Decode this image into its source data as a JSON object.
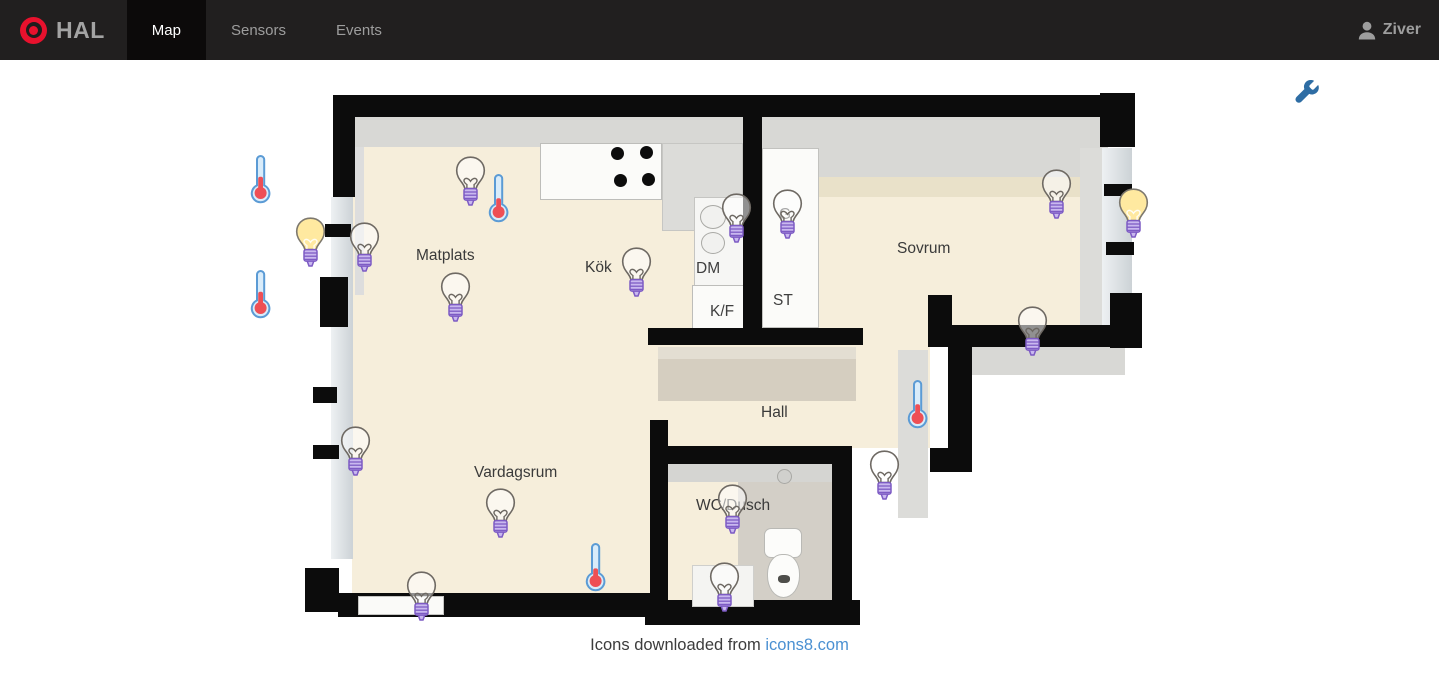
{
  "navbar": {
    "brand": "HAL",
    "tabs": [
      {
        "label": "Map",
        "active": true
      },
      {
        "label": "Sensors",
        "active": false
      },
      {
        "label": "Events",
        "active": false
      }
    ],
    "user": "Ziver"
  },
  "footer": {
    "text": "Icons downloaded from ",
    "link_label": "icons8.com"
  },
  "colors": {
    "accent_red": "#e8112d",
    "wrench_blue": "#2e6da4",
    "link_blue": "#4a90d2",
    "bulb_on_yellow": "#ffe9a0",
    "bulb_base_purple": "#c9b8ef",
    "thermometer_red": "#ee4f55",
    "wall_black": "#0c0c0c",
    "floor_beige": "#f6eedb"
  },
  "floorplan": {
    "labels": [
      {
        "label": "Matplats",
        "x": 416,
        "y": 247,
        "kind": "room"
      },
      {
        "label": "Kök",
        "x": 585,
        "y": 259,
        "kind": "room"
      },
      {
        "label": "Sovrum",
        "x": 897,
        "y": 240,
        "kind": "room"
      },
      {
        "label": "Hall",
        "x": 761,
        "y": 404,
        "kind": "room"
      },
      {
        "label": "Vardagsrum",
        "x": 474,
        "y": 464,
        "kind": "room"
      },
      {
        "label": "WC/Dusch",
        "x": 696,
        "y": 497,
        "kind": "room"
      },
      {
        "label": "DM",
        "x": 696,
        "y": 260,
        "kind": "appliance"
      },
      {
        "label": "K/F",
        "x": 710,
        "y": 303,
        "kind": "appliance"
      },
      {
        "label": "ST",
        "x": 773,
        "y": 292,
        "kind": "appliance"
      },
      {
        "label": "G",
        "x": 779,
        "y": 206,
        "kind": "appliance"
      }
    ],
    "sensors": [
      {
        "id": "temp-left-upper",
        "type": "thermometer",
        "level": 0.55,
        "x": 249,
        "y": 152
      },
      {
        "id": "temp-left-lower",
        "type": "thermometer",
        "level": 0.55,
        "x": 249,
        "y": 267
      },
      {
        "id": "temp-matplats",
        "type": "thermometer",
        "level": 0.45,
        "x": 487,
        "y": 171
      },
      {
        "id": "temp-hall",
        "type": "thermometer",
        "level": 0.45,
        "x": 906,
        "y": 377
      },
      {
        "id": "temp-vardagsrum",
        "type": "thermometer",
        "level": 0.4,
        "x": 584,
        "y": 540
      },
      {
        "id": "lamp-entry",
        "type": "bulb",
        "state": "on",
        "x": 294,
        "y": 216
      },
      {
        "id": "lamp-sovrum-window",
        "type": "bulb",
        "state": "on",
        "x": 1117,
        "y": 187
      },
      {
        "id": "lamp-matplats-wall",
        "type": "bulb",
        "state": "off",
        "x": 348,
        "y": 221
      },
      {
        "id": "lamp-matplats-top",
        "type": "bulb",
        "state": "off",
        "x": 454,
        "y": 155
      },
      {
        "id": "lamp-matplats",
        "type": "bulb",
        "state": "off",
        "x": 439,
        "y": 271
      },
      {
        "id": "lamp-kok",
        "type": "bulb",
        "state": "off",
        "x": 620,
        "y": 246
      },
      {
        "id": "lamp-sink",
        "type": "bulb",
        "state": "off",
        "x": 720,
        "y": 192
      },
      {
        "id": "lamp-garderob",
        "type": "bulb",
        "state": "off",
        "x": 771,
        "y": 188
      },
      {
        "id": "lamp-sovrum-top",
        "type": "bulb",
        "state": "off",
        "x": 1040,
        "y": 168
      },
      {
        "id": "lamp-sovrum-bottom",
        "type": "bulb",
        "state": "off",
        "x": 1016,
        "y": 305
      },
      {
        "id": "lamp-hall",
        "type": "bulb",
        "state": "off",
        "x": 868,
        "y": 449
      },
      {
        "id": "lamp-vardagsrum-wall",
        "type": "bulb",
        "state": "off",
        "x": 339,
        "y": 425
      },
      {
        "id": "lamp-vardagsrum",
        "type": "bulb",
        "state": "off",
        "x": 484,
        "y": 487
      },
      {
        "id": "lamp-vardagsrum-bottom",
        "type": "bulb",
        "state": "off",
        "x": 405,
        "y": 570
      },
      {
        "id": "lamp-wc",
        "type": "bulb",
        "state": "off",
        "x": 716,
        "y": 483
      },
      {
        "id": "lamp-wc-bottom",
        "type": "bulb",
        "state": "off",
        "x": 708,
        "y": 561
      }
    ]
  }
}
